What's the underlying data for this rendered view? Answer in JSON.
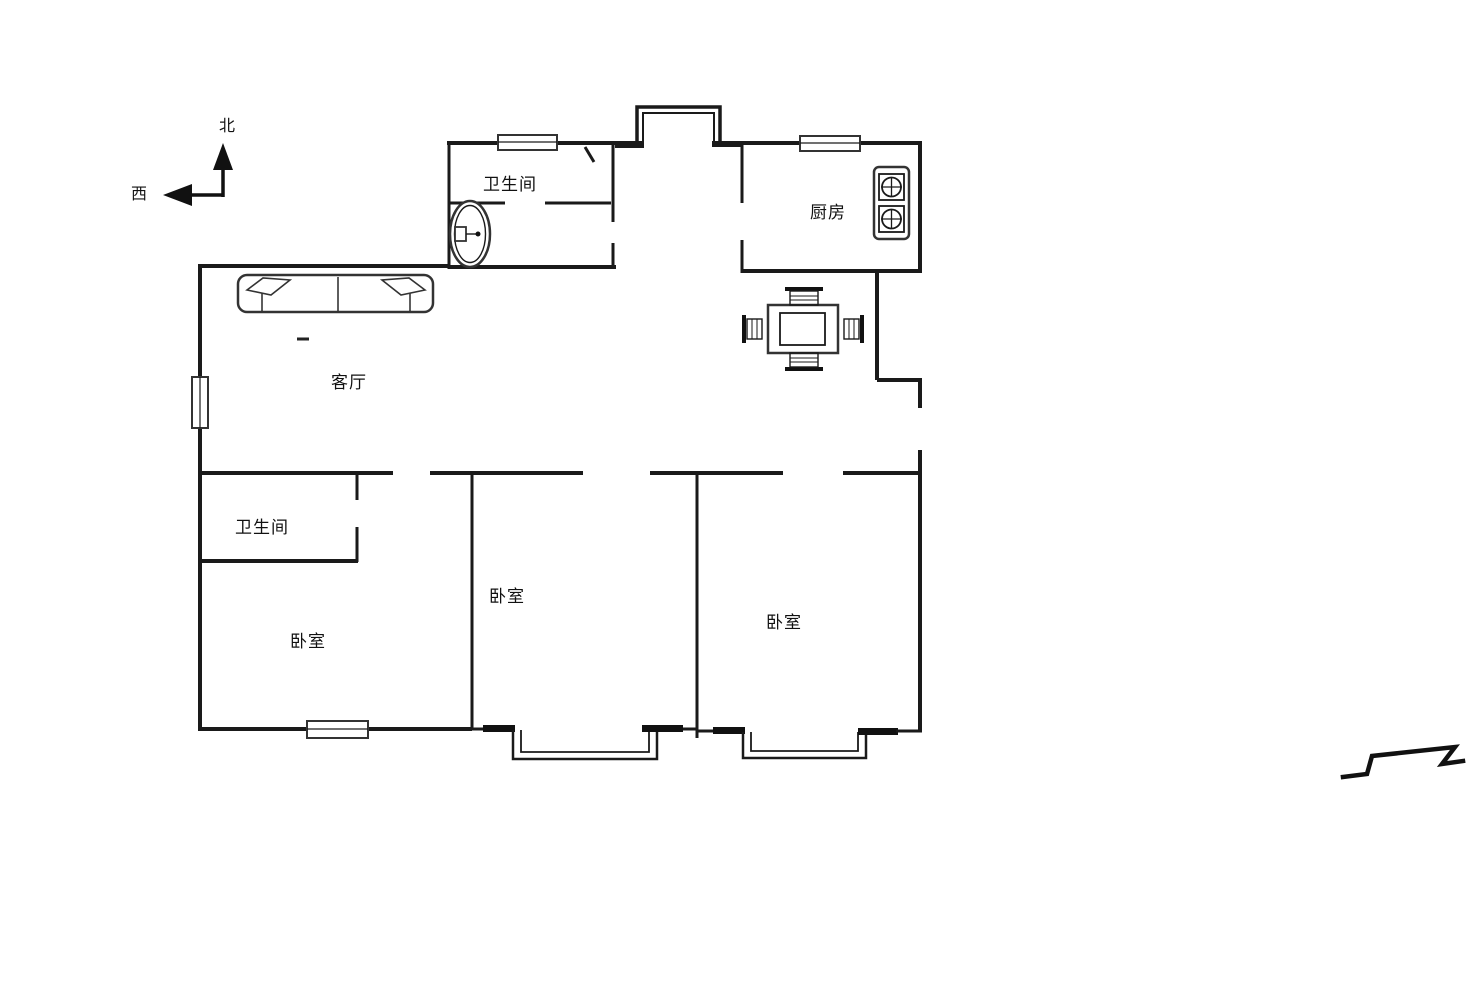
{
  "diagram": {
    "type": "floor-plan",
    "background_color": "#ffffff",
    "line_color": "#1a1a1a"
  },
  "compass": {
    "north_label": "北",
    "west_label": "西"
  },
  "rooms": {
    "bathroom_top": "卫生间",
    "kitchen": "厨房",
    "living_room": "客厅",
    "bathroom_lower": "卫生间",
    "bedroom_left": "卧室",
    "bedroom_middle": "卧室",
    "bedroom_right": "卧室"
  }
}
